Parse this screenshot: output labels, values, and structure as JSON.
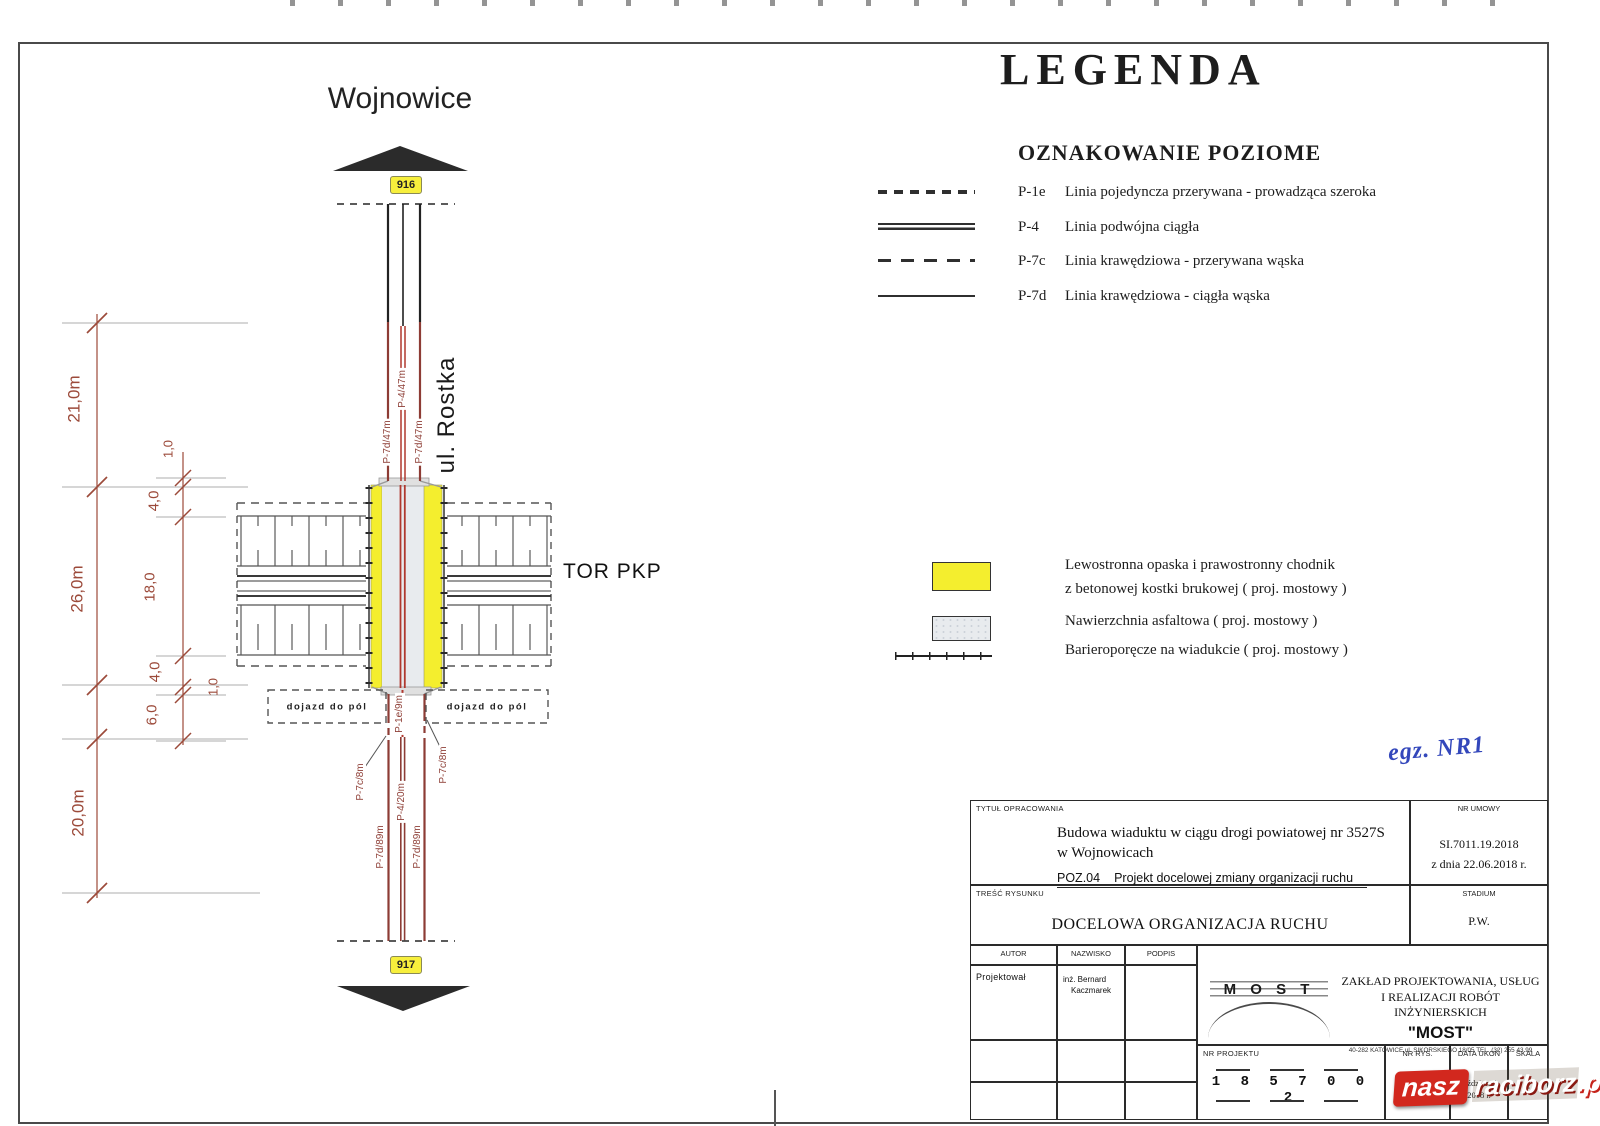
{
  "drawing": {
    "destination_top": "Wojnowice",
    "route_badge_top": "916",
    "route_badge_bottom": "917",
    "street_name": "ul. Rostka",
    "railway_label": "TOR PKP",
    "field_access_left": "dojazd do pól",
    "field_access_right": "dojazd do pól",
    "markings": {
      "upper_edge_left": "P-7d/47m",
      "upper_center": "P-4/47m",
      "upper_edge_right": "P-7d/47m",
      "below_viaduct": "P-1e/9m",
      "edge_gap_left": "P-7c/8m",
      "edge_gap_right": "P-7c/8m",
      "lower_center": "P-4/20m",
      "lower_edge_left": "P-7d/89m",
      "lower_edge_right": "P-7d/89m"
    },
    "dimensions": {
      "outer_21": "21,0m",
      "outer_26": "26,0m",
      "outer_20": "20,0m",
      "seg_6": "6,0",
      "seg_1_top": "1,0",
      "seg_4_top": "4,0",
      "seg_18": "18,0",
      "seg_4_bottom": "4,0",
      "seg_1_bottom": "1,0"
    }
  },
  "legend": {
    "title": "LEGENDA",
    "section_title": "OZNAKOWANIE  POZIOME",
    "line_items": [
      {
        "code": "P-1e",
        "desc": "Linia pojedyncza przerywana - prowadząca szeroka"
      },
      {
        "code": "P-4",
        "desc": "Linia podwójna ciągła"
      },
      {
        "code": "P-7c",
        "desc": "Linia krawędziowa - przerywana wąska"
      },
      {
        "code": "P-7d",
        "desc": "Linia krawędziowa - ciągła wąska"
      }
    ],
    "area_items": [
      {
        "desc_line1": "Lewostronna opaska i prawostronny chodnik",
        "desc_line2": "z betonowej kostki brukowej ( proj. mostowy )"
      },
      {
        "desc_line1": "Nawierzchnia asfaltowa ( proj. mostowy )"
      },
      {
        "desc_line1": "Barieroporęcze na wiadukcie ( proj. mostowy )"
      }
    ]
  },
  "annotations": {
    "copy_number": "egz. NR1"
  },
  "title_block": {
    "tytul_label": "TYTUŁ OPRACOWANIA",
    "tytul_line1": "Budowa wiaduktu w ciągu drogi powiatowej nr 3527S",
    "tytul_line2": "w Wojnowicach",
    "poz_code": "POZ.04",
    "poz_desc": "Projekt docelowej zmiany organizacji ruchu",
    "nr_umowy_label": "NR UMOWY",
    "nr_umowy_value": "SI.7011.19.2018",
    "nr_umowy_date": "z dnia 22.06.2018 r.",
    "tresc_label": "TREŚĆ RYSUNKU",
    "tresc_value": "DOCELOWA ORGANIZACJA RUCHU",
    "stadium_label": "STADIUM",
    "stadium_value": "P.W.",
    "autor_label": "AUTOR",
    "nazwisko_label": "NAZWISKO",
    "podpis_label": "PODPIS",
    "autor_role": "Projektował",
    "autor_name_line1": "inż. Bernard",
    "autor_name_line2": "Kaczmarek",
    "logo_text": "M O S T",
    "company_line1": "ZAKŁAD PROJEKTOWANIA, USŁUG",
    "company_line2": "I REALIZACJI ROBÓT INŻYNIERSKICH",
    "company_name": "\"MOST\"",
    "company_address": "40-282 KATOWICE ul. SIKORSKIEGO 18/05   TEL. (32) 255 43 99",
    "nr_projektu_label": "NR PROJEKTU",
    "nr_projektu_value": "1 8  5 7 0  0 2",
    "nr_rys_label": "NR RYS.",
    "data_label": "DATA UKOŃ",
    "data_value_line1": "październik",
    "data_value_line2": "2018 r.",
    "skala_label": "SKALA",
    "skala_value": "-"
  },
  "watermark": {
    "part1": "nasz",
    "part2": "raciborz",
    "part3": ".pl"
  },
  "colors": {
    "sidewalk_yellow": "#f4ee2e",
    "asphalt_gray": "#e8ebee",
    "dimension_red": "#9c4a3a",
    "marking_red": "#b0392f",
    "edge_dark_red": "#8d3c35",
    "handwriting_blue": "#3a52c4",
    "watermark_red": "#d2281e",
    "badge_yellow": "#f7ef3c"
  }
}
